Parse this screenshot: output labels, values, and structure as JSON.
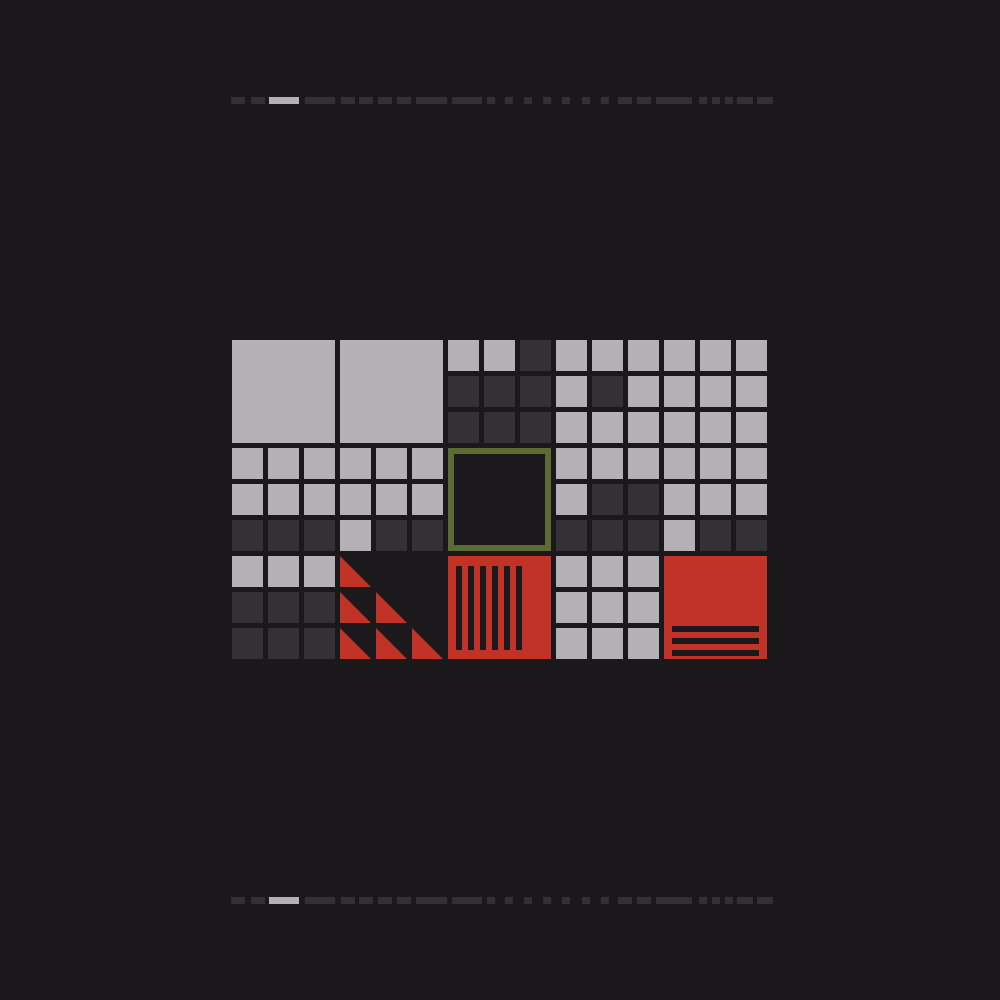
{
  "canvas": {
    "width": 1000,
    "height": 1000,
    "background": "#1a181b"
  },
  "palette": {
    "light_gray": "#b3b1b4",
    "dark_gray": "#333136",
    "red": "#c23327",
    "olive": "#5c6b33",
    "tile_interior": "#1b191c",
    "stripe_black": "#1a181b",
    "dash_dark": "#323035"
  },
  "dividers": {
    "top_y": 97,
    "bottom_y": 897,
    "height": 7,
    "segments": [
      [
        231,
        14,
        "dark"
      ],
      [
        251,
        14,
        "dark"
      ],
      [
        269,
        30,
        "light"
      ],
      [
        305,
        30,
        "dark"
      ],
      [
        341,
        14,
        "dark"
      ],
      [
        359,
        14,
        "dark"
      ],
      [
        378,
        14,
        "dark"
      ],
      [
        397,
        14,
        "dark"
      ],
      [
        416,
        31,
        "dark"
      ],
      [
        452,
        30,
        "dark"
      ],
      [
        487,
        8,
        "dark"
      ],
      [
        505,
        8,
        "dark"
      ],
      [
        524,
        8,
        "dark"
      ],
      [
        543,
        8,
        "dark"
      ],
      [
        562,
        8,
        "dark"
      ],
      [
        582,
        8,
        "dark"
      ],
      [
        601,
        8,
        "dark"
      ],
      [
        618,
        14,
        "dark"
      ],
      [
        637,
        14,
        "dark"
      ],
      [
        656,
        36,
        "dark"
      ],
      [
        699,
        8,
        "dark"
      ],
      [
        712,
        8,
        "dark"
      ],
      [
        725,
        8,
        "dark"
      ],
      [
        737,
        16,
        "dark"
      ],
      [
        757,
        16,
        "dark"
      ]
    ]
  },
  "mosaic": {
    "origin_x": 232,
    "origin_y": 340,
    "cols": 15,
    "rows": 9,
    "cell_size": 31,
    "pitch": 36,
    "tile_size": 103,
    "cell_rows": [
      "......LLDLLLLLL",
      "......DDDLDLLLL",
      "......DDDLLLLLL",
      "LLLLLL...LLLLLL",
      "LLLLLL...LDDLLL",
      "DDDLDD...DDDLDD",
      "LLL......LLL...",
      "DDD......LLL...",
      "DDD......LLL..."
    ],
    "tiles": [
      {
        "type": "solid-square",
        "name": "solid-gray-tile-1",
        "row": 0,
        "col": 0
      },
      {
        "type": "solid-square",
        "name": "solid-gray-tile-2",
        "row": 0,
        "col": 3
      },
      {
        "type": "outlined-square",
        "name": "olive-outlined-tile",
        "row": 3,
        "col": 6
      },
      {
        "type": "triangle-grid",
        "name": "red-triangles-tile",
        "row": 6,
        "col": 3
      },
      {
        "type": "vertical-stripes",
        "name": "red-vstripes-tile",
        "row": 6,
        "col": 6
      },
      {
        "type": "horizontal-stripes",
        "name": "red-hstripes-tile",
        "row": 6,
        "col": 12
      }
    ],
    "triangle_cells": [
      [
        0,
        0
      ],
      [
        1,
        0
      ],
      [
        1,
        1
      ],
      [
        2,
        0
      ],
      [
        2,
        1
      ],
      [
        2,
        2
      ]
    ],
    "vstripes": {
      "count": 6,
      "left": 8,
      "top": 10,
      "bottom": 9,
      "width": 6,
      "pitch": 12
    },
    "hstripes": {
      "offsets": [
        70,
        82,
        94
      ],
      "left": 8,
      "right": 8,
      "height": 6
    },
    "outline_border": 6
  }
}
